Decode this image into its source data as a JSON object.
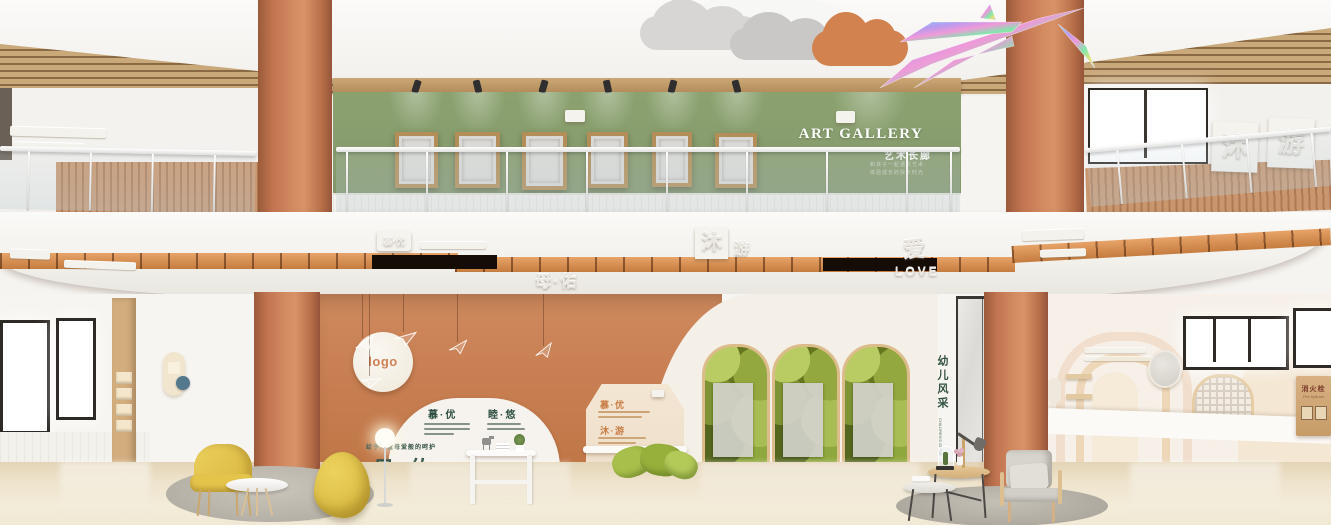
{
  "palette": {
    "terracotta": "#c9805a",
    "sage_green": "#879b6d",
    "copper_strip": "#d28c54",
    "cream": "#f2ece2",
    "wood": "#c7a274",
    "green_text": "#2e4f41",
    "orange_text": "#c97e4e",
    "yellow_furniture": "#e2c34f",
    "leaf_green": "#7e9434"
  },
  "gallery": {
    "title": "ART GALLERY",
    "subtitle": "艺术长廊",
    "tagline_line1": "和孩子一起遇见艺术",
    "tagline_line2": "体验成长的快乐时光"
  },
  "fascia": {
    "small_sign": "慕·优",
    "mu_plate": "沐",
    "you_char": "游",
    "ai_char": "爱",
    "love": "LOVE",
    "brand": "母·佑"
  },
  "upper_right_sign": {
    "char1": "沐",
    "char2": "游"
  },
  "feature_wall": {
    "logo": "logo",
    "arch_label_left": "慕·优",
    "arch_label_right": "睦·悠",
    "house_label_top": "慕·优",
    "house_label_bottom": "沐·游",
    "brand_caption": "给予儿童母爱般的呵护",
    "brand": "母·佑"
  },
  "children_style": {
    "cn": "幼儿风采",
    "en": "CHILDREN'S STYLE"
  },
  "fire_hydrant": {
    "cn": "消火栓",
    "en": "Fire hydrant"
  }
}
